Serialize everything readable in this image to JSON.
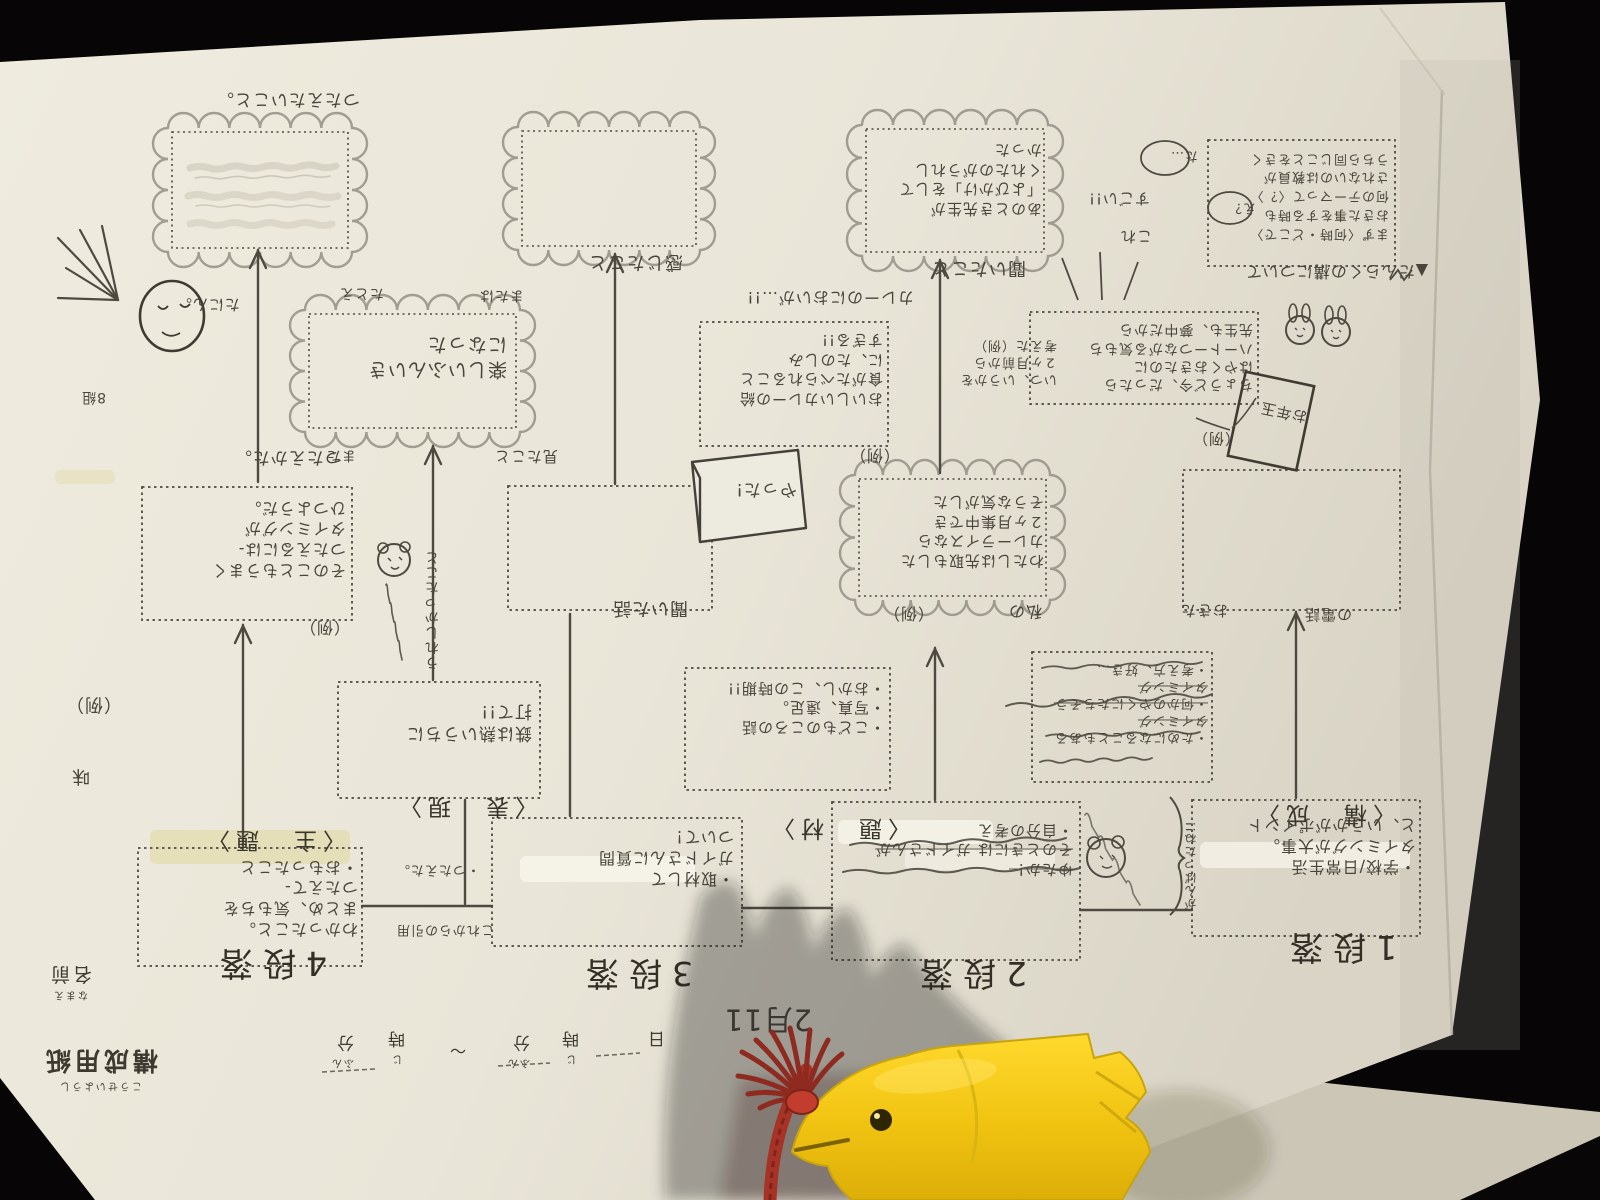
{
  "printed": {
    "sheet_title": "構成用紙",
    "sheet_title_kana": "こうせいようし",
    "name_label": "名前",
    "name_kana": "なまえ",
    "time_ji": "時",
    "time_ji_kana": "じ",
    "time_fun": "分",
    "time_fun_kana": "ふん",
    "tilde": "～",
    "day": "日"
  },
  "headings": {
    "danraku_note": "▲だんらくの構について",
    "date_hw": "2月11"
  },
  "sections": {
    "s1": "1段落",
    "s2": "2段落",
    "s3": "3段落",
    "s4": "4段落"
  },
  "categories": {
    "shudai": "〈主　題〉",
    "hyogen": "〈表　現〉",
    "daizai": "〈題　材〉",
    "kosei": "〈構　成〉"
  },
  "col_shudai": {
    "cloud_caption": "つたえたいこと。",
    "how_caption": "つたえかた。",
    "how_box": [
      "そのこともうまく",
      "つたえるには-",
      "タイミングが",
      "ひつようだ。"
    ],
    "rei": "（例）",
    "bottom_box": [
      "わかったこと。",
      "まとめ、気もちを",
      "つたえて-",
      "・おもったこと"
    ]
  },
  "col_hyogen": {
    "cloud_caption": "感じたこと",
    "empty_caption": "聞いた話",
    "bottom_box": [
      "・取材して",
      "ガイドさんに質問",
      "ついて！"
    ],
    "side_note_a": "・つたえた。",
    "side_note_b": "これからの引用",
    "iron_box": [
      "鉄は熱いうちに",
      "打て!!"
    ],
    "vertical_note": "うれしかったこと",
    "cloud2": [
      "楽しいふんいき",
      "になった"
    ],
    "tatoe": "たとえ",
    "mataha": "または",
    "mata": "また",
    "mita": "見たこと"
  },
  "col_daizai": {
    "cloud3": [
      "あのとき先生が",
      "「よびかけ」をして",
      "くれたのがうれし",
      "かった"
    ],
    "cloud3_caption": "聞いたこと",
    "sugoi": "すごい!!",
    "kore": "これ",
    "curry_note": "カレーのにおいが…!!",
    "curry_box": [
      "おいしいカレーの給",
      "食がたべられること",
      "に、たのしみ",
      "すぎる!!"
    ],
    "rei": "（例）",
    "banner": "やった!",
    "side_note": [
      "いつ、いうかを",
      "２ヶ月前から",
      "考えた（例）"
    ],
    "mid_cloud": [
      "わたしは先取もした",
      "カレーライスなら",
      "２ヶ月集中でき",
      "そうな気がした"
    ],
    "mid_rei": "（例）",
    "watashino": "私の",
    "list_box": [
      "・こどものころの話",
      "・写真、遠足。",
      "・おかし、この時期!!"
    ],
    "crossed_box": [
      "・ためになることもある",
      "タイミング",
      "・何かのやくにたちそう",
      "タイミング",
      "・考え方、好き…"
    ],
    "bottom_box": [
      "ゆたか！",
      "そのときには ガイドさんが",
      "・自分の考え"
    ]
  },
  "col_kosei": {
    "notes_box": [
      "まず〈何時・どこで〉",
      "おきた事をする時も",
      "何のテーマって〈？〉",
      "されないのは教員が",
      "うちら同じことをきく"
    ],
    "circ_ta": "た…",
    "circ_e": "え？",
    "wish_box": [
      "ちょうど今、だったら",
      "はやくおきたのに",
      "ハートーつながる気もち",
      "先生も、夢中だから"
    ],
    "wish_rei": "（例）",
    "card": "お年玉",
    "okita": "おきた",
    "denwa": "の電話",
    "bottom_box": [
      "・学校/日常生活",
      "タイミングが大事。",
      "と、いうかがポイント"
    ],
    "brace_note": "がんばったね!!"
  },
  "margin": {
    "tanin": "たにん。",
    "kumi": "8組",
    "rei": "（例）",
    "aji": "味"
  }
}
